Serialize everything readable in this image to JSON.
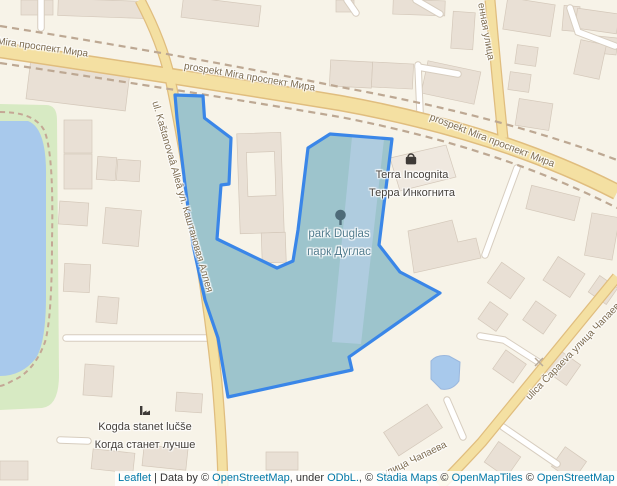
{
  "map": {
    "road_labels": {
      "mira_left": "Mira проспект Мира",
      "mira_center": "prospekt Mira проспект Мира",
      "mira_right": "prospekt Mira проспект Мира",
      "kashtanovaya": "ul. Kaštanovaâ Alleâ ул. Каштановая Аллея",
      "vennaya": "енная улица",
      "chapaeva_upper": "ulica Čapaeva улица Чапаева",
      "chapaeva_lower": "улица Чапаева"
    },
    "poi_labels": {
      "terra_latin": "Terra Incognita",
      "terra_cyrillic": "Терра Инкогнита",
      "park_latin": "park Duglas",
      "park_cyrillic": "парк Дуглас",
      "kogda_latin": "Kogda stanet lučše",
      "kogda_cyrillic": "Когда станет лучше"
    },
    "icons": [
      "tree-icon",
      "shopping-bag-icon",
      "factory-icon",
      "crossing-x-icon"
    ],
    "colors": {
      "land": "#f7f3e8",
      "building": "#e9e0d5",
      "grass": "#d7eac3",
      "water": "#a8c9ec",
      "road_fill": "#f4e0a2",
      "road_casing": "#e0bd7e",
      "railway_dash": "#bda893",
      "selection_border": "#3a86e8",
      "selection_fill": "#9dc4cc",
      "selection_path_fill": "#afccdf",
      "link_blue": "#0078a8"
    }
  },
  "attribution": {
    "leaflet": "Leaflet",
    "sep": " | Data by © ",
    "osm1": "OpenStreetMap",
    "under": ", under ",
    "odbl": "ODbL.",
    "c1": ", © ",
    "stadia": "Stadia Maps",
    "c2": " © ",
    "openmaptiles": "OpenMapTiles",
    "c3": " © ",
    "osm2": "OpenStreetMap",
    "contributors": " contributors"
  }
}
